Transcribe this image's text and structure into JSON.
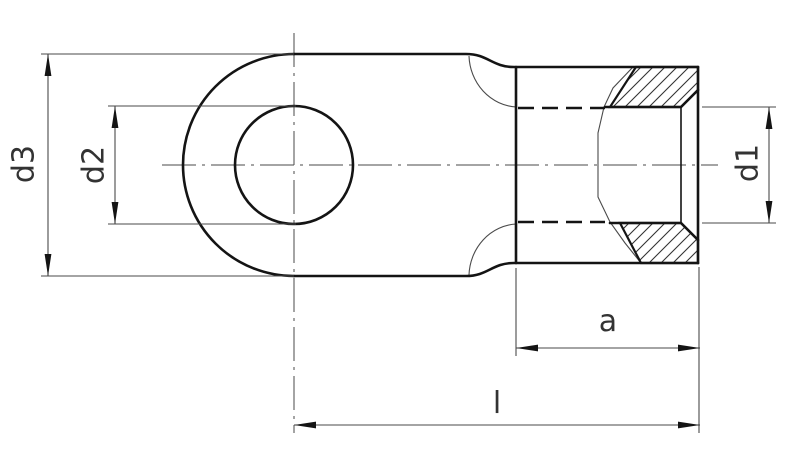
{
  "drawing": {
    "dimensions": {
      "d3": {
        "label": "d3"
      },
      "d2": {
        "label": "d2"
      },
      "d1": {
        "label": "d1"
      },
      "a": {
        "label": "a"
      },
      "l": {
        "label": "l"
      }
    },
    "colors": {
      "background": "#ffffff",
      "line": "#141414",
      "thin_line": "#4a4a4a",
      "text": "#333333"
    }
  }
}
